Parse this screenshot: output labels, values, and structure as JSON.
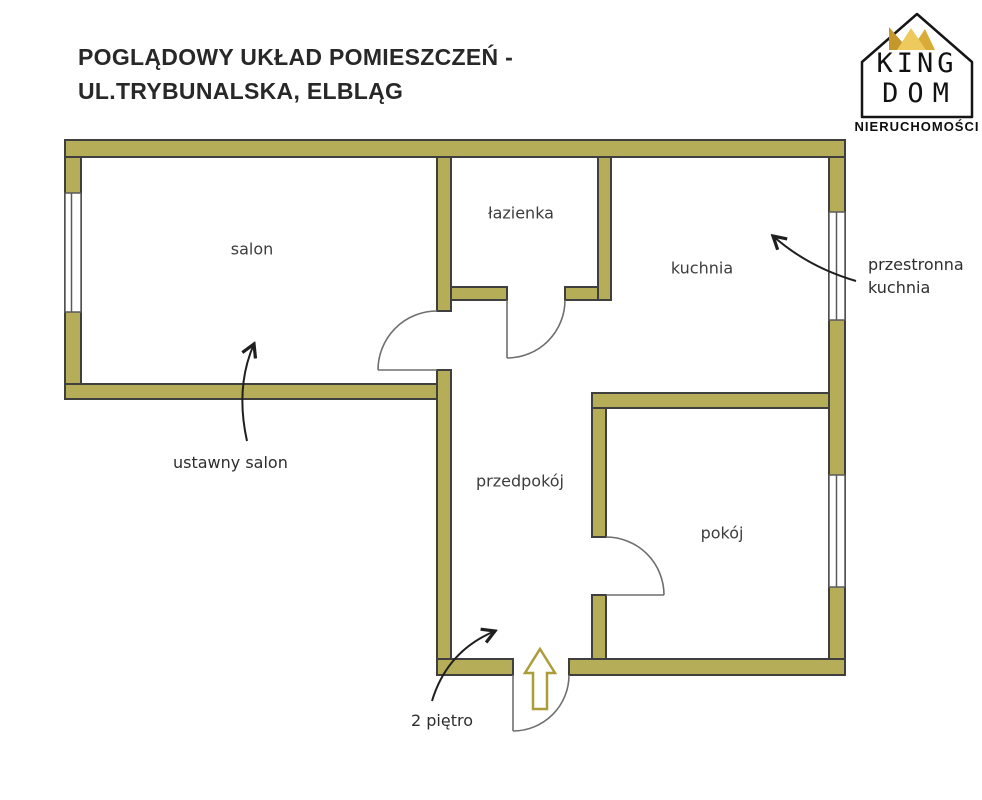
{
  "title": {
    "line1": "POGLĄDOWY UKŁAD POMIESZCZEŃ -",
    "line2": "UL.TRYBUNALSKA, ELBLĄG"
  },
  "logo": {
    "line1": "KING",
    "line2": "DOM",
    "subtitle": "NIERUCHOMOŚCI",
    "icon": "crown-icon"
  },
  "rooms": {
    "salon": "salon",
    "lazienka": "łazienka",
    "kuchnia": "kuchnia",
    "przedpokoj": "przedpokój",
    "pokoj": "pokój"
  },
  "annotations": {
    "salon_note": "ustawny salon",
    "kuchnia_note": "przestronna kuchnia",
    "floor_note": "2 piętro"
  },
  "colors": {
    "wall_fill": "#b5ad58",
    "wall_stroke": "#3f3f3f",
    "window_stroke": "#5a5a5a",
    "door_stroke": "#6e6e6e",
    "ink": "#1f1f1f",
    "gold": "#ac9c3a",
    "crown_dark": "#c6972b",
    "crown_light": "#eeca5e",
    "crown_mid": "#d9ab37",
    "label": "#3d3d3d"
  }
}
